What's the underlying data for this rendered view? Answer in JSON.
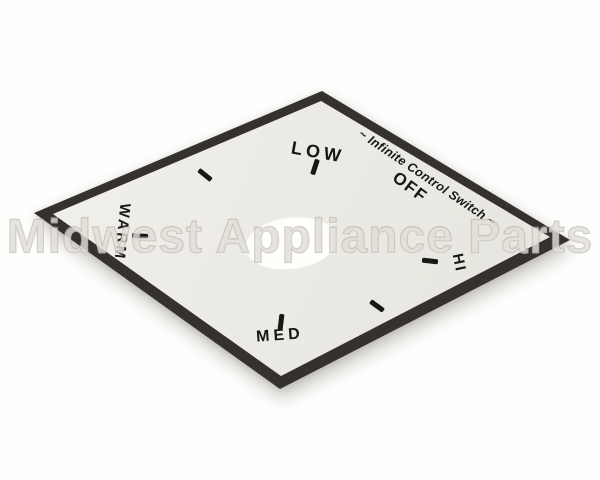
{
  "watermark": {
    "text": "Midwest Appliance Parts"
  },
  "plate": {
    "edge_text": "~ Infinite Control Switch ~",
    "labels": {
      "low": "LOW",
      "off": "OFF",
      "warm": "WARM",
      "med": "MED",
      "hi": "HI"
    },
    "tick_positions": [
      "low",
      "upper-left",
      "warm",
      "med",
      "lower-right",
      "hi"
    ],
    "colors": {
      "background": "#fefefd",
      "face": "#edebe4",
      "border": "#34312e",
      "text": "#171717",
      "watermark": "rgba(211,206,196,0.55)"
    }
  }
}
